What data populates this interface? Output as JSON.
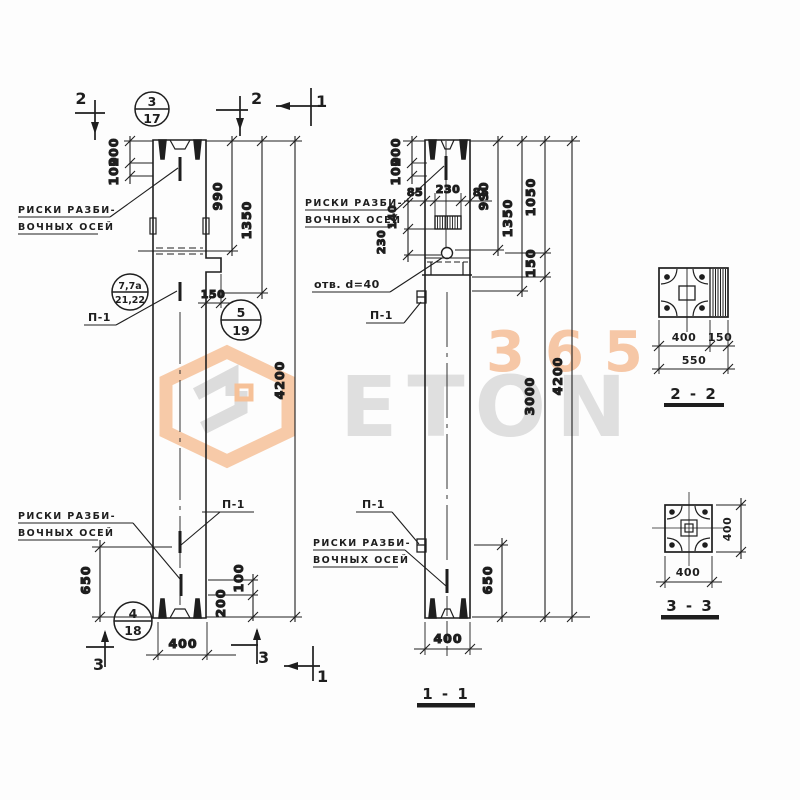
{
  "watermark": {
    "word": "ETON",
    "number": "365"
  },
  "titles": {
    "main": "1 - 1",
    "sec2": "2 - 2",
    "sec3": "3 - 3"
  },
  "labels": {
    "riski1": "РИСКИ РАЗБИ-",
    "riski2": "ВОЧНЫХ ОСЕЙ",
    "otv": "отв. d=40",
    "p1": "П-1"
  },
  "callouts": [
    {
      "top": "3",
      "bottom": "17"
    },
    {
      "top": "7,7а",
      "bottom": "21,22"
    },
    {
      "top": "5",
      "bottom": "19"
    },
    {
      "top": "4",
      "bottom": "18"
    }
  ],
  "cuts": {
    "one": "1",
    "two": "2",
    "three": "3"
  },
  "dims": {
    "d85": "85",
    "d100": "100",
    "d140": "140",
    "d150": "150",
    "d200": "200",
    "d230": "230",
    "d400": "400",
    "d550": "550",
    "d650": "650",
    "d990": "990",
    "d1050": "1050",
    "d1350": "1350",
    "d3000": "3000",
    "d4200": "4200"
  },
  "colors": {
    "ink": "#1e1e1e",
    "accent_orange": "#f2a975",
    "watermark_gray": "#dcdcdc"
  }
}
